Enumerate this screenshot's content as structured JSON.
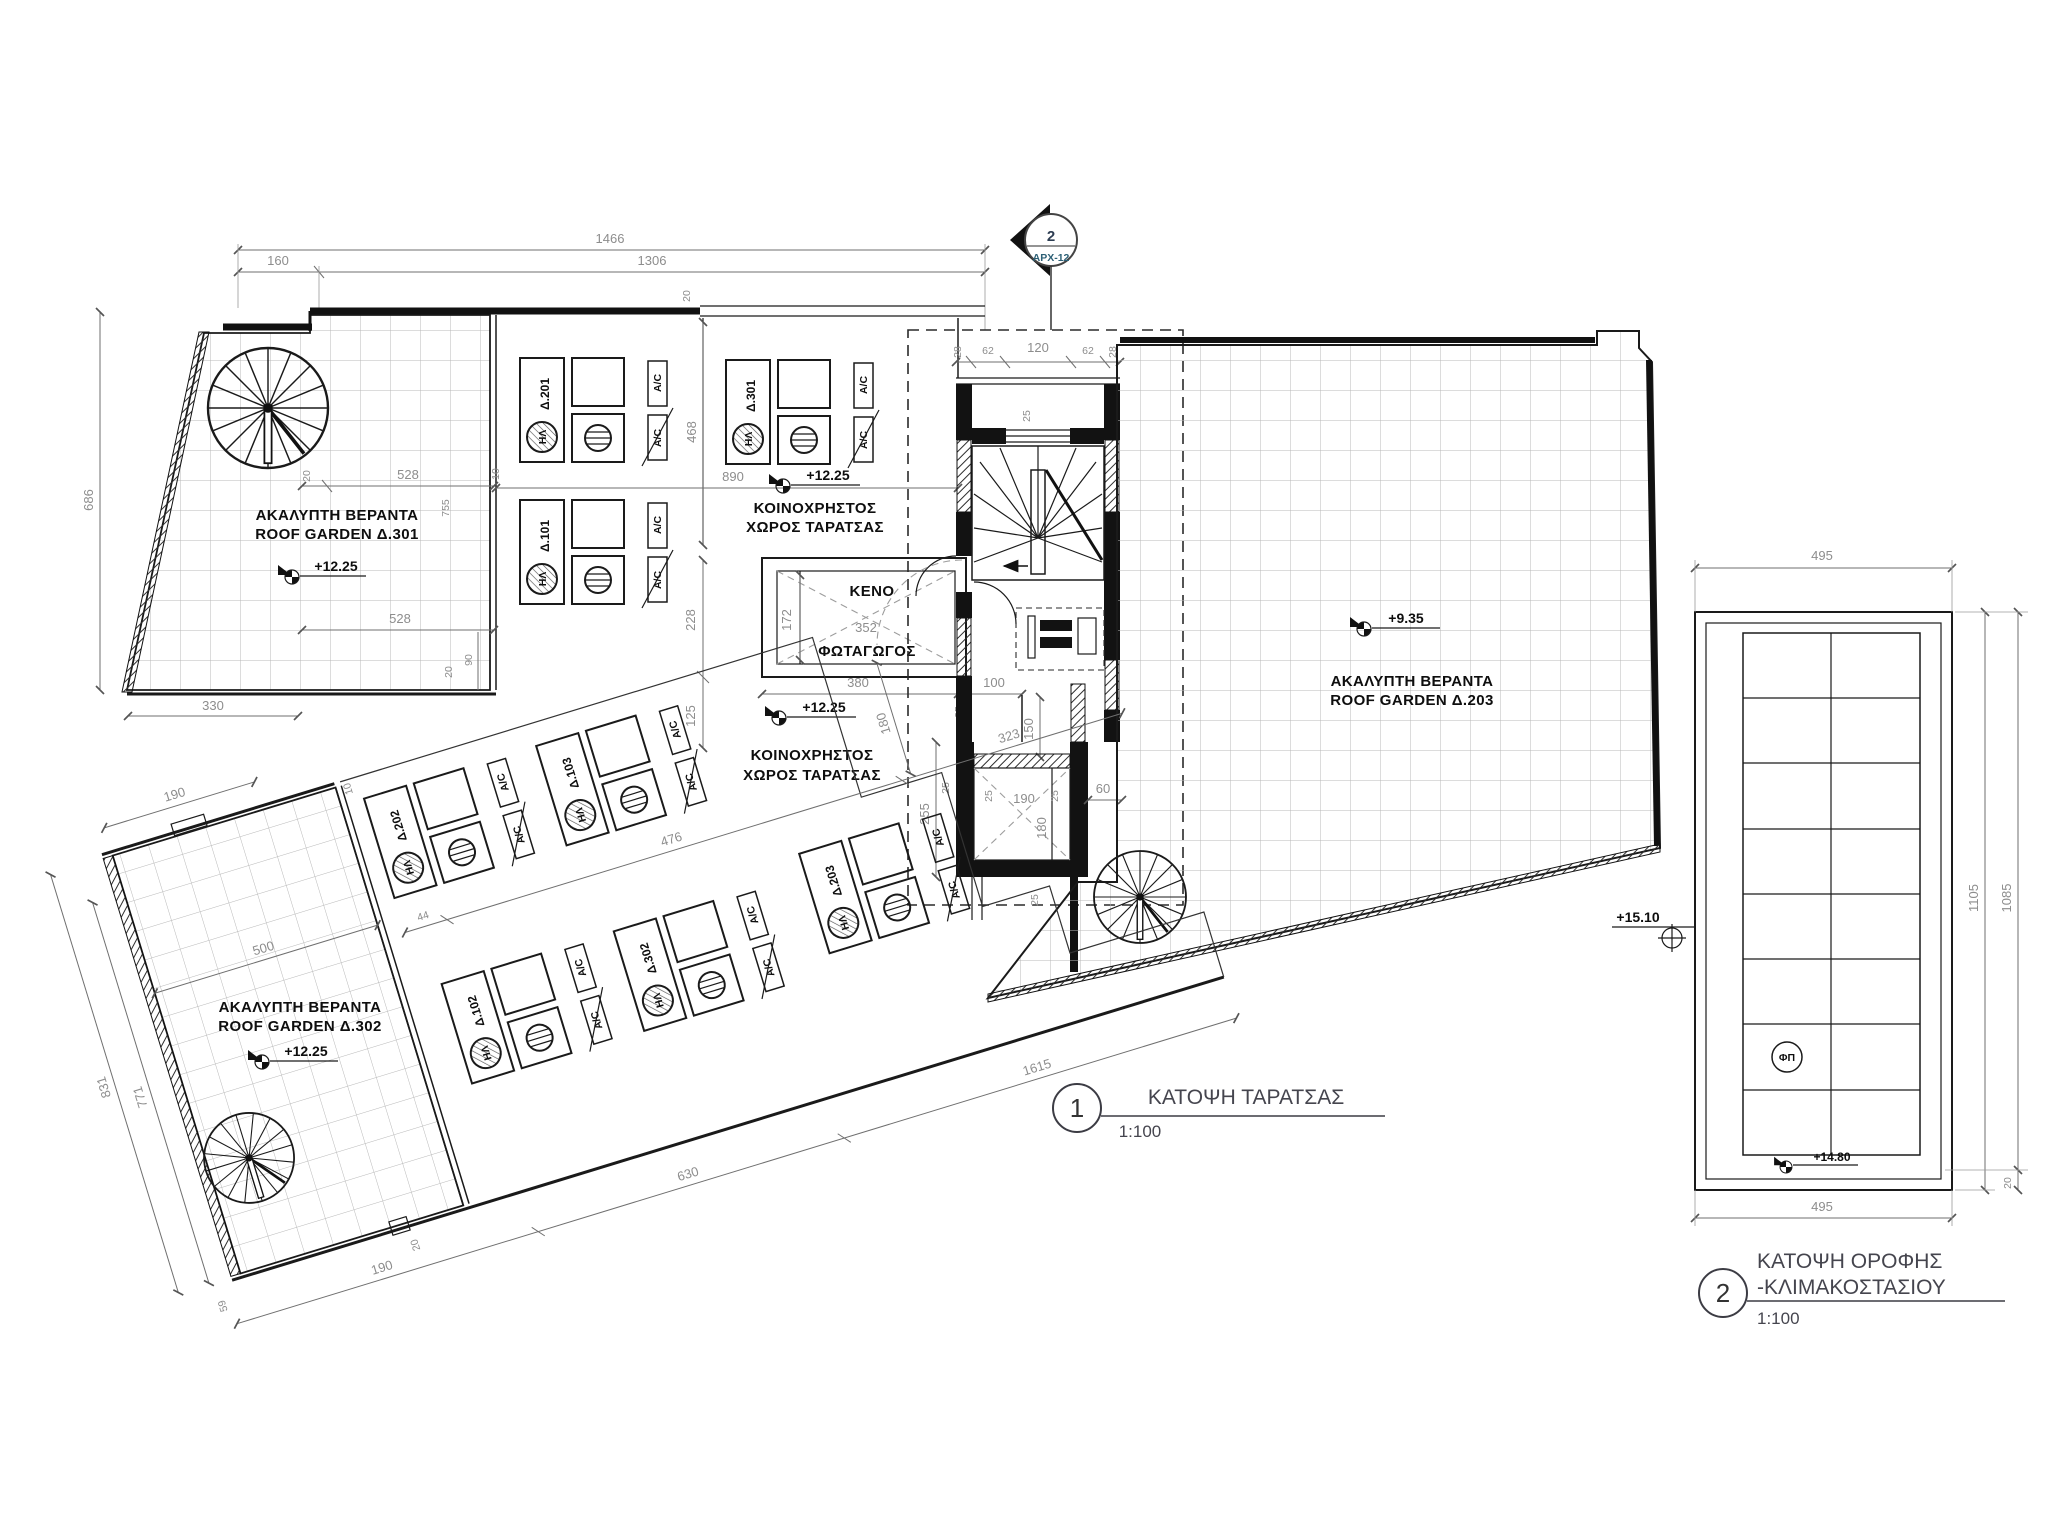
{
  "marker": {
    "number": "2",
    "sheet": "ΑΡΧ-12"
  },
  "plan1": {
    "number": "1",
    "name": "ΚΑΤΟΨΗ ΤΑΡΑΤΣΑΣ",
    "scale": "1:100"
  },
  "plan2": {
    "number": "2",
    "name1": "ΚΑΤΟΨΗ ΟΡΟΦΗΣ",
    "name2": "-ΚΛΙΜΑΚΟΣΤΑΣΙΟΥ",
    "scale": "1:100"
  },
  "labels": {
    "akalipti": "ΑΚΑΛΥΠΤΗ ΒΕΡΑΝΤΑ",
    "rg301": "ROOF GARDEN Δ.301",
    "rg302": "ROOF GARDEN Δ.302",
    "rg203": "ROOF GARDEN Δ.203",
    "koin1": "ΚΟΙΝΟΧΡΗΣΤΟΣ",
    "koin2": "ΧΩΡΟΣ ΤΑΡΑΤΣΑΣ",
    "keno": "ΚΕΝΟ",
    "fotagogos": "ΦΩΤΑΓΩΓΟΣ",
    "fp": "ΦΠ"
  },
  "levels": {
    "l1225": "+12.25",
    "l935": "+9.35",
    "l1510": "+15.10",
    "l1480": "+14.80"
  },
  "units": {
    "ac": "A/C",
    "solar": "ΗΛ",
    "u201": "Δ.201",
    "u301": "Δ.301",
    "u101": "Δ.101",
    "u202": "Δ.202",
    "u103": "Δ.103",
    "u102": "Δ.102",
    "u302": "Δ.302",
    "u203": "Δ.203"
  },
  "dims": {
    "t1466": "1466",
    "t160": "160",
    "t1306": "1306",
    "t20": "20",
    "v686": "686",
    "b330": "330",
    "g20a": "20",
    "g528a": "528",
    "g755": "755",
    "g10": "10",
    "g528b": "528",
    "g90": "90",
    "g20b": "20",
    "v468": "468",
    "h890": "890",
    "v228": "228",
    "v125": "125",
    "k172": "172",
    "k352": "352",
    "k380": "380",
    "k100": "100",
    "k25": "25",
    "c28a": "28",
    "c62a": "62",
    "c120": "120",
    "c62b": "62",
    "c28b": "28",
    "c25": "25",
    "e150": "150",
    "e255": "255",
    "e25a": "25",
    "e190": "190",
    "e25b": "25",
    "e60": "60",
    "e180": "180",
    "e25c": "25",
    "e25d": "25",
    "r190a": "190",
    "r500": "500",
    "r10": "10",
    "r831": "831",
    "r771": "771",
    "r59": "59",
    "r190b": "190",
    "r630": "630",
    "r1615": "1615",
    "r20": "20",
    "r44": "44",
    "r476": "476",
    "r323": "323",
    "r180": "180",
    "p495a": "495",
    "p495b": "495",
    "p1105": "1105",
    "p1085": "1085",
    "p20": "20"
  }
}
